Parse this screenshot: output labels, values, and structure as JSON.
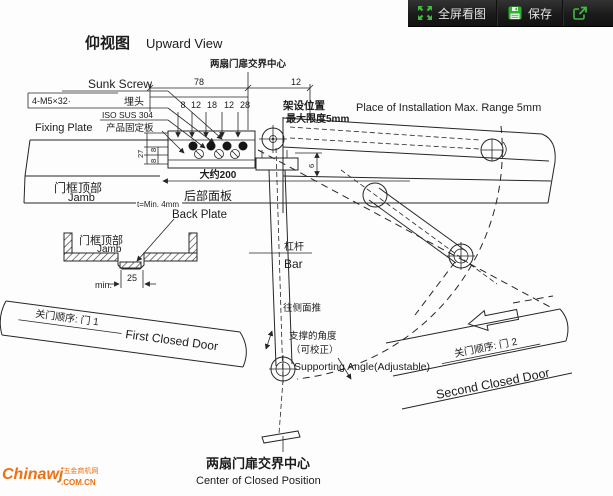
{
  "toolbar": {
    "fullscreen_label": "全屏看图",
    "save_label": "保存",
    "icons": {
      "fullscreen": "expand-arrows-icon",
      "save": "floppy-icon",
      "share": "share-icon"
    },
    "accent_green": "#3fba3f",
    "bg": "#1e1e1e"
  },
  "title": {
    "zh": "仰视图",
    "en": "Upward View"
  },
  "diagram": {
    "top_center_label": "两扇门扉交界中心",
    "labels": {
      "sunk_screw_en": "Sunk Screw",
      "screw_spec": "4-M5×32·",
      "sunk_screw_zh": "埋头",
      "material": "ISO SUS 304",
      "fixing_plate_en": "Fixing Plate",
      "fixing_plate_zh": "产品固定板",
      "install_zh": "架设位置",
      "install_limit_zh": "最大限度5mm",
      "install_en": "Place of Installation Max. Range 5mm",
      "jamb_zh": "门框顶部",
      "jamb_en": "Jamb",
      "approx_200": "大约200",
      "back_plate_zh": "后部面板",
      "back_plate_en": "Back Plate",
      "thickness": "t=Min. 4mm",
      "section_jamb_zh": "门框顶部",
      "section_jamb_en": "Jamb",
      "section_min": "min.",
      "section_25": "25",
      "door1_zh": "关门顺序: 门 1",
      "door1_en": "First Closed Door",
      "bar_zh": "杠杆",
      "bar_en": "Bar",
      "push_zh": "往侧面推",
      "support_zh1": "支撑的角度",
      "support_zh2": "（可校正）",
      "support_en": "Supporting Angle(Adjustable)",
      "door2_zh": "关门顺序: 门 2",
      "door2_en": "Second Closed Door",
      "bottom_zh": "两扇门扉交界中心",
      "bottom_en": "Center of Closed Position"
    },
    "dims": {
      "top_78": "78",
      "top_12": "12",
      "row": [
        "8",
        "12",
        "18",
        "12",
        "28"
      ],
      "left_27": "27",
      "left_8a": "8",
      "left_8b": "8",
      "right_6": "6"
    }
  },
  "watermark": {
    "brand": "Chinawj",
    "tagline": "五金商机网",
    "domain": ".COM.CN"
  }
}
